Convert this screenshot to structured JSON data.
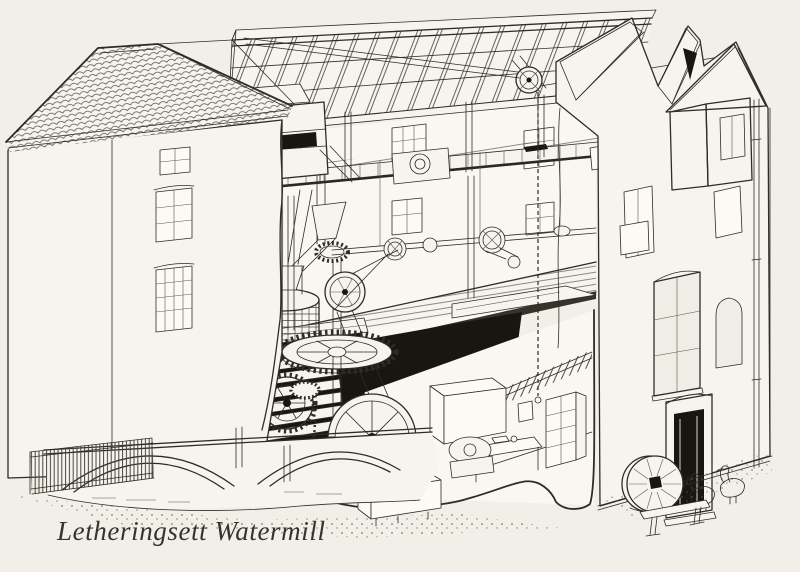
{
  "caption": {
    "text": "Letheringsett Watermill"
  },
  "palette": {
    "paper": "#f1efe8",
    "ink": "#2e2c26",
    "wall": "#f6f4ee",
    "deep_shadow": "#17160f"
  },
  "scene": {
    "type": "cutaway line illustration",
    "subject": "three-storey watermill sectioned to reveal interior machinery",
    "components": [
      "tiled gable roof",
      "open rafter roof",
      "sack-hoist pulley and rope",
      "lucam hoist dormer",
      "weatherboarding",
      "bin floor",
      "stone floor",
      "grain chutes",
      "flour dresser",
      "millstone tun and hopper",
      "great spur wheel",
      "stone nut gears",
      "line shaft with pulleys",
      "drive belts",
      "waterwheel",
      "pit wheel",
      "governor",
      "engine flywheel",
      "grain bin",
      "work table",
      "shelf rack",
      "bridge arches over mill race",
      "sluice fence",
      "arched window",
      "loading door",
      "doorway",
      "downpipe",
      "leaning millstone",
      "two geese",
      "wooden bench"
    ]
  }
}
